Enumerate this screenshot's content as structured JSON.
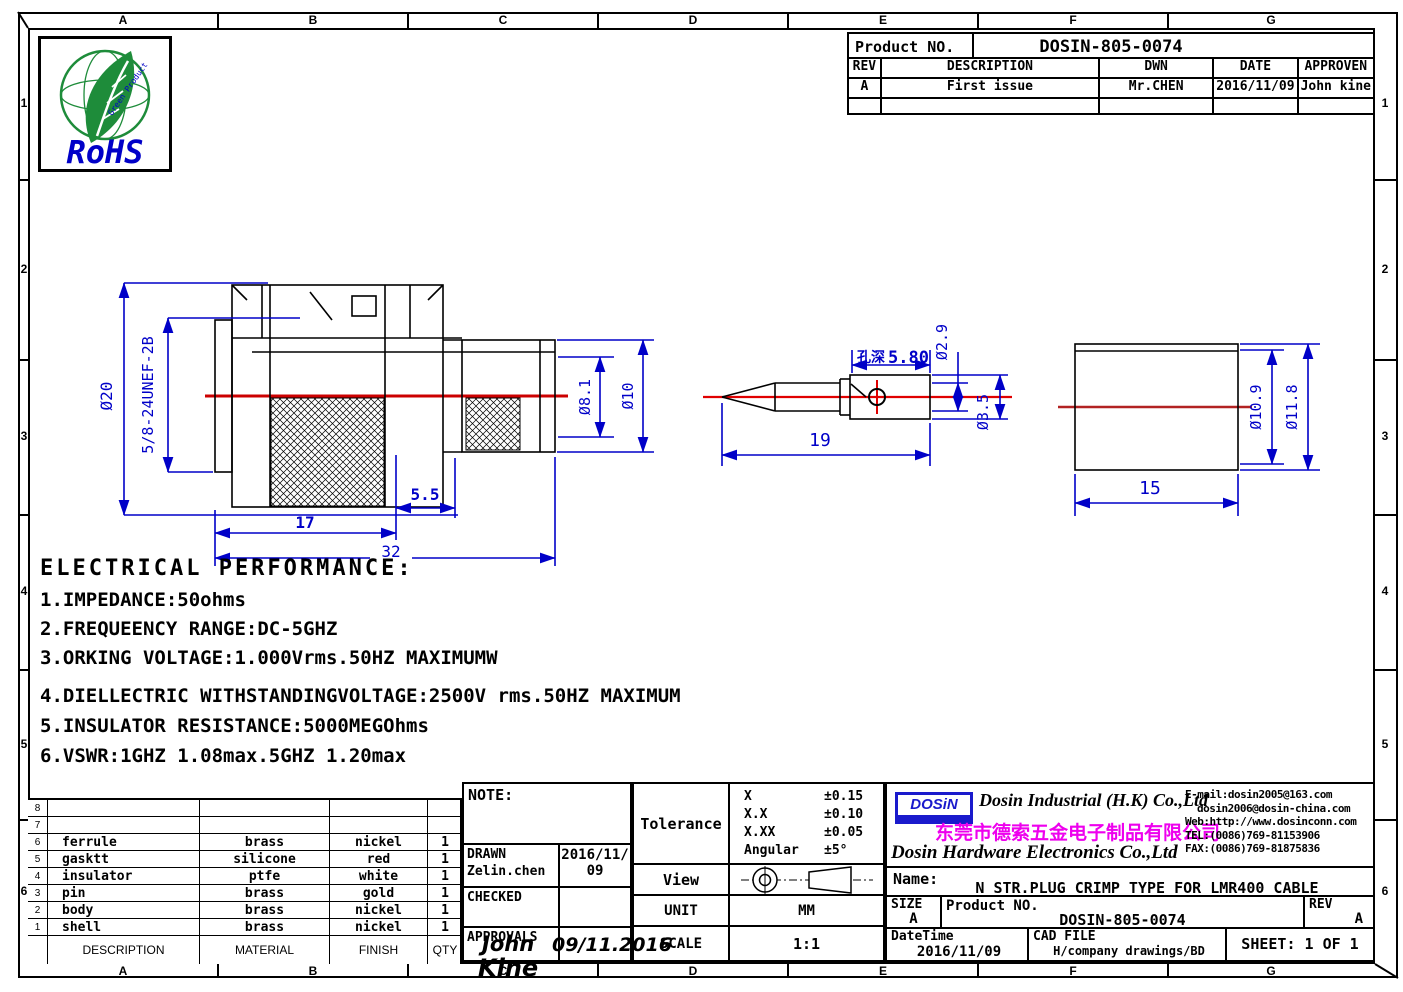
{
  "frame": {
    "cols": [
      "A",
      "B",
      "C",
      "D",
      "E",
      "F",
      "G"
    ],
    "rows": [
      "1",
      "2",
      "3",
      "4",
      "5",
      "6"
    ]
  },
  "rohs": {
    "label": "RoHS",
    "leaf_text": "Green Product"
  },
  "revision_table": {
    "product_no_label": "Product NO.",
    "product_no": "DOSIN-805-0074",
    "headers": [
      "REV",
      "DESCRIPTION",
      "DWN",
      "DATE",
      "APPROVEN"
    ],
    "row": {
      "rev": "A",
      "description": "First issue",
      "dwn": "Mr.CHEN",
      "date": "2016/11/09",
      "approven": "John kine"
    }
  },
  "drawings": {
    "connector": {
      "dia20": "Ø20",
      "thread": "5/8-24UNEF-2B",
      "dia81": "Ø8.1",
      "dia10": "Ø10",
      "len55": "5.5",
      "len17": "17",
      "len32": "32"
    },
    "pin": {
      "len19": "19",
      "hole_depth_label": "孔深",
      "hole_depth": "5.80",
      "dia29": "Ø2.9",
      "dia35": "Ø3.5"
    },
    "sleeve": {
      "dia109": "Ø10.9",
      "dia118": "Ø11.8",
      "len15": "15"
    }
  },
  "electrical": {
    "title": "ELECTRICAL PERFORMANCE:",
    "items": [
      "1.IMPEDANCE:50ohms",
      "2.FREQUEENCY RANGE:DC-5GHZ",
      "3.ORKING VOLTAGE:1.000Vrms.50HZ MAXIMUMW",
      "4.DIELLECTRIC WITHSTANDINGVOLTAGE:2500V rms.50HZ MAXIMUM",
      "5.INSULATOR RESISTANCE:5000MEGOhms",
      "6.VSWR:1GHZ 1.08max.5GHZ 1.20max"
    ]
  },
  "parts_table": {
    "headers": [
      "DESCRIPTION",
      "MATERIAL",
      "FINISH",
      "QTY"
    ],
    "rows": [
      {
        "no": "8",
        "description": "",
        "material": "",
        "finish": "",
        "qty": ""
      },
      {
        "no": "7",
        "description": "",
        "material": "",
        "finish": "",
        "qty": ""
      },
      {
        "no": "6",
        "description": "ferrule",
        "material": "brass",
        "finish": "nickel",
        "qty": "1"
      },
      {
        "no": "5",
        "description": "gasktt",
        "material": "silicone",
        "finish": "red",
        "qty": "1"
      },
      {
        "no": "4",
        "description": "insulator",
        "material": "ptfe",
        "finish": "white",
        "qty": "1"
      },
      {
        "no": "3",
        "description": "pin",
        "material": "brass",
        "finish": "gold",
        "qty": "1"
      },
      {
        "no": "2",
        "description": "body",
        "material": "brass",
        "finish": "nickel",
        "qty": "1"
      },
      {
        "no": "1",
        "description": "shell",
        "material": "brass",
        "finish": "nickel",
        "qty": "1"
      }
    ]
  },
  "note_block": {
    "note_label": "NOTE:",
    "drawn_label": "DRAWN",
    "drawn_name": "Zelin.chen",
    "drawn_date_l1": "2016/11/",
    "drawn_date_l2": "09",
    "checked_label": "CHECKED",
    "approvals_label": "APPROVALS",
    "approvals_sig": "John",
    "approvals_sig2": "Kine",
    "approvals_date": "09/11.2016"
  },
  "tolerance_block": {
    "label": "Tolerance",
    "rows": [
      {
        "sym": "X",
        "val": "±0.15"
      },
      {
        "sym": "X.X",
        "val": "±0.10"
      },
      {
        "sym": "X.XX",
        "val": "±0.05"
      },
      {
        "sym": "Angular",
        "val": "±5°"
      }
    ],
    "view_label": "View",
    "unit_label": "UNIT",
    "unit_value": "MM",
    "scale_label": "SCALE",
    "scale_value": "1:1"
  },
  "company": {
    "logo": "DOSiN",
    "name_en1": "Dosin Industrial (H.K) Co.,Ltd",
    "name_cn": "东莞市德索五金电子制品有限公司",
    "name_en2": "Dosin Hardware Electronics Co.,Ltd",
    "email1": "E-mail:dosin2005@163.com",
    "email2": "dosin2006@dosin-china.com",
    "web": "Web:http://www.dosinconn.com",
    "tel": "TEL:(0086)769-81153906",
    "fax": "FAX:(0086)769-81875836"
  },
  "title_block": {
    "name_label": "Name:",
    "name_value": "N STR.PLUG CRIMP TYPE FOR LMR400 CABLE",
    "size_label": "SIZE",
    "size_value": "A",
    "product_no_label": "Product NO.",
    "product_no": "DOSIN-805-0074",
    "rev_label": "REV",
    "rev_value": "A",
    "datetime_label": "DateTime",
    "datetime_value": "2016/11/09",
    "cad_label": "CAD FILE",
    "cad_value": "H/company drawings/BD",
    "sheet": "SHEET: 1 OF 1"
  }
}
